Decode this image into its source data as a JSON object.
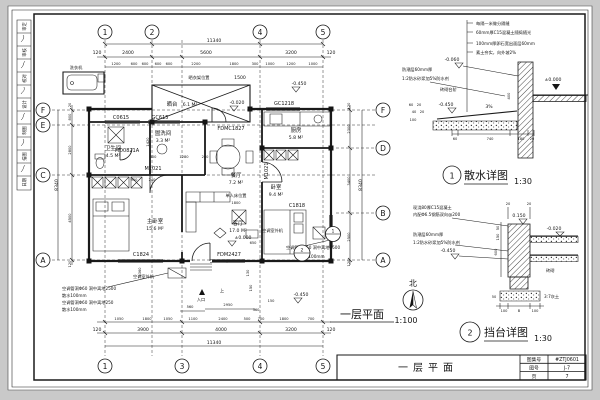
{
  "page": {
    "bg": "#c9c9c9",
    "sheet": "#ffffff",
    "ink": "#1a1a1a"
  },
  "signature_strip": {
    "labels": [
      "审定",
      "审核",
      "校对",
      "设计",
      "制图",
      "描图",
      "日期"
    ]
  },
  "plan": {
    "title": "一层平面",
    "scale": "1:100",
    "north": "北",
    "entrance": "入口",
    "up": "上",
    "grid": {
      "top": [
        "1",
        "2",
        "4",
        "5"
      ],
      "bottom": [
        "1",
        "3",
        "4",
        "5"
      ],
      "left": [
        "F",
        "E",
        "C",
        "A"
      ],
      "right": [
        "F",
        "D",
        "B",
        "A"
      ]
    },
    "rooms": [
      {
        "name": "卫生间",
        "area": "4.5 M²"
      },
      {
        "name": "盥洗间",
        "area": "3.3 M²"
      },
      {
        "name": "厨房",
        "area": "5.8 M²"
      },
      {
        "name": "餐厅",
        "area": "7.2 M²"
      },
      {
        "name": "主卧室",
        "area": "15.6 M²"
      },
      {
        "name": "客厅",
        "area": "17.0 M²"
      },
      {
        "name": "卧室",
        "area": "9.4 M²"
      },
      {
        "name": "晒台",
        "area": "6.1 M²"
      }
    ],
    "openings": {
      "c0615": "C0615",
      "gc615": "GC615",
      "gc1218": "GC1218",
      "fdmc1827": "FDMC1827",
      "md0821a": "MD0821A",
      "m1021": "M1021",
      "c1824": "C1824",
      "fdm2427": "FDM2427",
      "c1818": "C1818"
    },
    "levels": {
      "zero": "±0.000",
      "m020": "-0.020",
      "m450": "-0.450"
    },
    "annotations": {
      "drying_rack": "晒衣架位置",
      "washer": "洗衣机",
      "bed_note": "单人床位置",
      "bed_note_dim": "1800",
      "ac_unit": "空调室外机",
      "ac_hole_2500": "空调管洞Φ60 洞中离地2500",
      "ac_hole_250": "空调管洞Φ60 洞中离地250",
      "apron": "散水100mm"
    },
    "dims": {
      "overall": "11340",
      "v_overall": "8340",
      "top_main": [
        "120",
        "2400",
        "5600",
        "3200",
        "120"
      ],
      "top_sub": [
        "1200",
        "600",
        "600",
        "600",
        "600",
        "2200",
        "1800",
        "300",
        "1000",
        "1200",
        "1000"
      ],
      "top_extra": "1500",
      "bottom_sub": [
        "1050",
        "1800",
        "1050",
        "1100",
        "2400",
        "500",
        "700",
        "1800",
        "700"
      ],
      "bottom_main": [
        "120",
        "3900",
        "4000",
        "3200",
        "120"
      ],
      "left_col": [
        "20",
        "800",
        "2800",
        "4500",
        "120"
      ],
      "right_col": [
        "120",
        "2300",
        "3400",
        "2500",
        "120"
      ],
      "entry": [
        "560",
        "2950",
        "360",
        "150"
      ],
      "inner": [
        "800",
        "1280",
        "240",
        "950",
        "240",
        "1420",
        "650",
        "1360",
        "130",
        "150"
      ]
    },
    "detail_marks": [
      "1",
      "2"
    ]
  },
  "detail1": {
    "num": "1",
    "title": "散水详图",
    "scale": "1:30",
    "notes": [
      "每隔一米做分隔缝",
      "60mm厚C15混凝土随捣随光",
      "100mm厚卵石宽出面层60mm",
      "素土夯实，向外坡2%"
    ],
    "side_notes": [
      "防潮层60mm厚",
      "1:2防水砂浆加5%防水剂"
    ],
    "step_note": "砖砌台阶",
    "levels": [
      "-0.060",
      "-0.450",
      "±0.000"
    ],
    "slope": "3%",
    "v_dim": "400",
    "bottom_dims": [
      "60",
      "740",
      "180",
      "20"
    ],
    "left_dims": [
      "60",
      "20",
      "40",
      "20",
      "100"
    ]
  },
  "detail2": {
    "num": "2",
    "title": "挡台详图",
    "scale": "1:30",
    "notes": [
      "现浇80厚C15混凝土",
      "内配Φ6.5钢筋双向@200",
      "防潮层60mm厚",
      "1:2防水砂浆加5%防水剂"
    ],
    "levels": [
      "0.150",
      "-0.020",
      "-0.450"
    ],
    "labels": {
      "brick": "砖砌",
      "lime": "3:7灰土"
    },
    "top_dims": [
      "20",
      "20"
    ],
    "left_dims": [
      "50",
      "150",
      "600"
    ],
    "base_dim": "50",
    "bottom_dims": [
      "100",
      "B",
      "100"
    ]
  },
  "titleblock": {
    "drawing_title": "一层平面",
    "rows": [
      {
        "label": "图集号",
        "value": "#ZTJ0601"
      },
      {
        "label": "图号",
        "value": "J-7"
      },
      {
        "label": "页",
        "value": "7"
      }
    ]
  }
}
